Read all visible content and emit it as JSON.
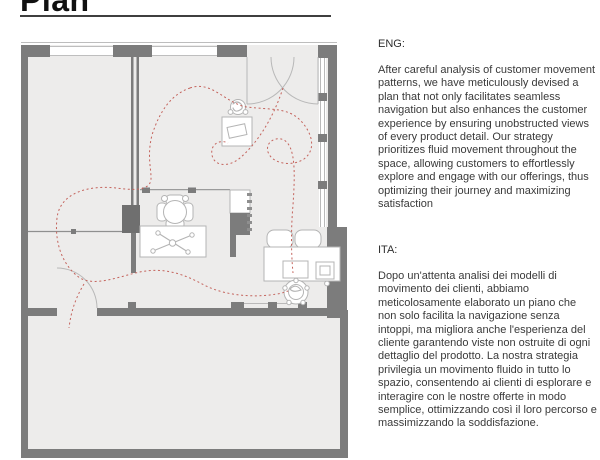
{
  "header": {
    "title": "Plan"
  },
  "sections": {
    "eng": {
      "label": "ENG:",
      "body": "After careful analysis of customer movement patterns, we have meticulously devised a plan that not only facilitates seamless navigation but also enhances the customer experience by ensuring unobstructed views of every product detail. Our strategy prioritizes fluid movement throughout the space, allowing customers to effortlessly explore and engage with our offerings, thus optimizing their journey and maximizing satisfaction"
    },
    "ita": {
      "label": "ITA:",
      "body": "Dopo un'attenta analisi dei modelli di movimento dei clienti, abbiamo meticolosamente elaborato un piano che non solo facilita la navigazione senza intoppi, ma migliora anche l'esperienza del cliente garantendo viste non ostruite di ogni dettaglio del prodotto. La nostra strategia privilegia un movimento fluido in tutto lo spazio, consentendo ai clienti di esplorare e interagire con le nostre offerte in modo semplice, ottimizzando così il loro percorso e massimizzando la soddisfazione."
    }
  },
  "plan": {
    "colors": {
      "wall": "#7c7c7c",
      "wall-dark": "#6f6f6f",
      "floor": "#edeceb",
      "furniture": "#b4b4b4",
      "line": "#b8b8b8",
      "red": "#c4635c",
      "text": "#3a3a3a",
      "underline": "#3f3f3f"
    },
    "elements": [
      "exterior-walls",
      "window-strips",
      "entrance-double-door",
      "interior-walls",
      "door-swing-arc",
      "round-table-with-chairs",
      "display-table-crossed-tools",
      "display-stand",
      "counter-shelf-unit",
      "desk-with-monitor",
      "guest-chairs",
      "office-chair",
      "customer-flow-dashed-paths"
    ]
  }
}
